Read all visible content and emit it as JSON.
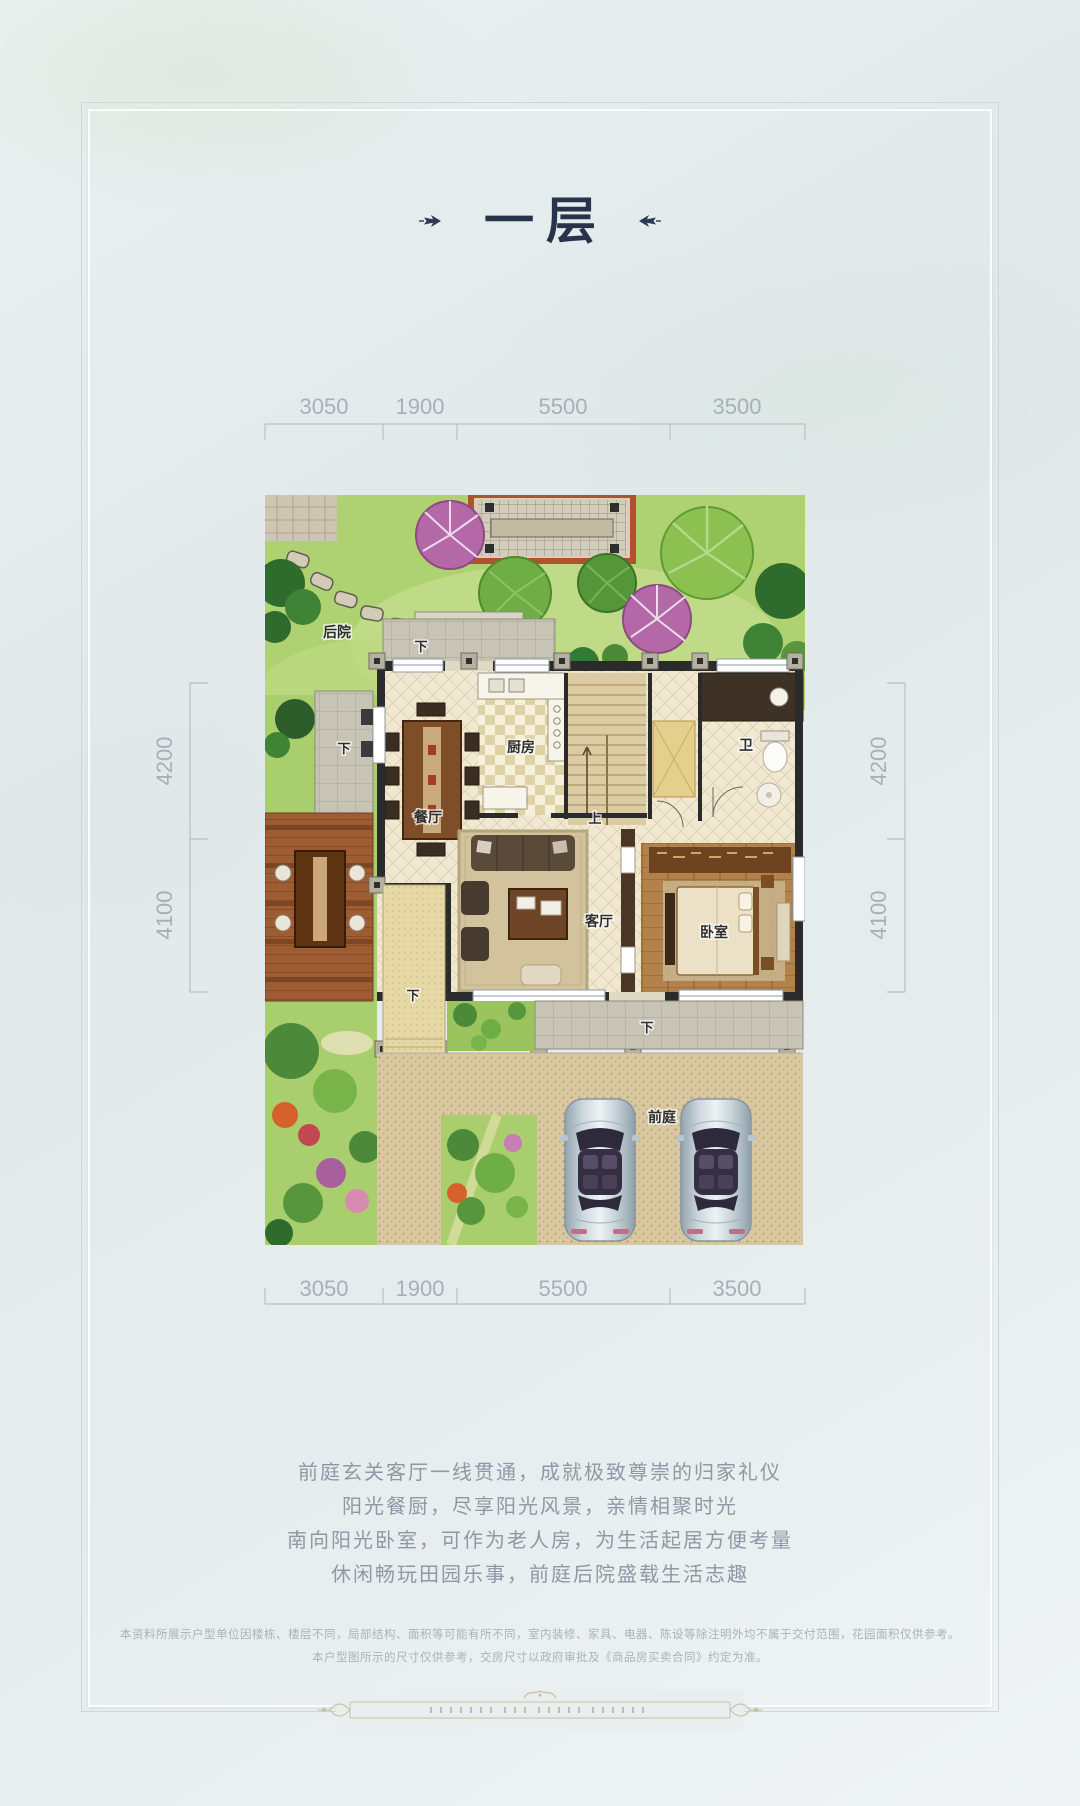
{
  "poster": {
    "title": "一层",
    "description_lines": [
      "前庭玄关客厅一线贯通，成就极致尊崇的归家礼仪",
      "阳光餐厨，尽享阳光风景，亲情相聚时光",
      "南向阳光卧室，可作为老人房，为生活起居方便考量",
      "休闲畅玩田园乐事，前庭后院盛载生活志趣"
    ],
    "disclaimer_lines": [
      "本资料所展示户型单位因楼栋、楼层不同，局部结构、面积等可能有所不同，室内装修、家具、电器、陈设等除注明外均不属于交付范围，花园面积仅供参考。",
      "本户型图所示的尺寸仅供参考，交房尺寸以政府审批及《商品房买卖合同》约定为准。"
    ]
  },
  "dimensions": {
    "top": [
      "3050",
      "1900",
      "5500",
      "3500"
    ],
    "bottom": [
      "3050",
      "1900",
      "5500",
      "3500"
    ],
    "left": [
      "4200",
      "4100"
    ],
    "right": [
      "4200",
      "4100"
    ]
  },
  "rooms": {
    "backyard": "后院",
    "dining": "餐厅",
    "kitchen": "厨房",
    "bathroom": "卫",
    "living": "客厅",
    "bedroom": "卧室",
    "front_yard": "前庭",
    "up": "上",
    "down": "下"
  },
  "colors": {
    "background": "#e4ebed",
    "title_ink": "#26334b",
    "dimension_text": "#a6b0b8",
    "body_text": "#8e99a5",
    "disclaimer_text": "#a9b3bb",
    "ornament_gold": "#c6c0a2",
    "lawn_green": "#aed171",
    "wall_dark": "#2b2b2b",
    "floor_cream": "#f0e8d0",
    "driveway_tan": "#d9c7a0",
    "pergola_red": "#b2522c"
  }
}
